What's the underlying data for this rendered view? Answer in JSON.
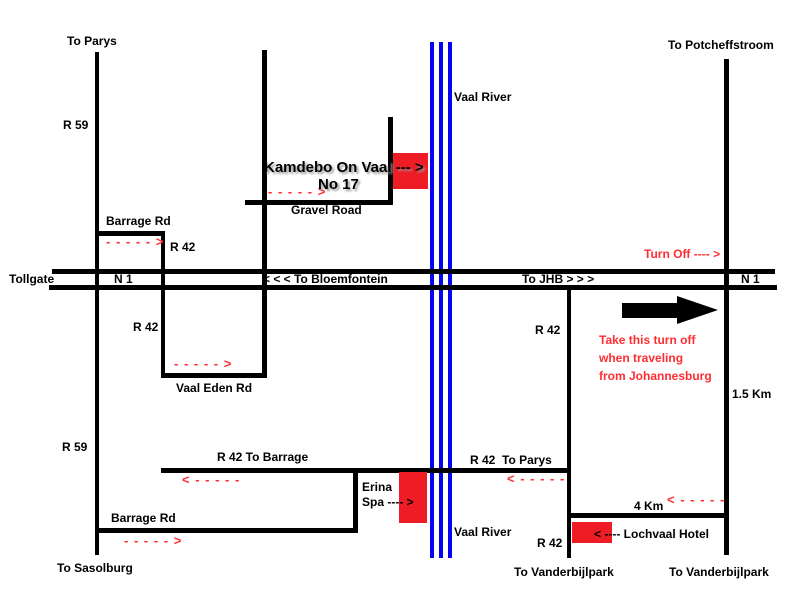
{
  "destinations": {
    "parys": "To Parys",
    "potcheffstroom": "To Potcheffstroom",
    "sasolburg": "To Sasolburg",
    "vanderbijlpark_left": "To Vanderbijlpark",
    "vanderbijlpark_right": "To Vanderbijlpark"
  },
  "highway": {
    "tollgate": "Tollgate",
    "n1_left": "N 1",
    "n1_right": "N 1",
    "to_bloemfontein": "< < < To Bloemfontein",
    "to_jhb": "To JHB > > >"
  },
  "roads": {
    "r59_top": "R 59",
    "r59_bottom": "R 59",
    "r42_top": "R 42",
    "r42_mid_left": "R 42",
    "r42_mid_right": "R 42",
    "r42_bottom": "R 42",
    "barrage_rd_top": "Barrage Rd",
    "barrage_rd_bottom": "Barrage Rd",
    "gravel_road": "Gravel Road",
    "vaal_eden_rd": "Vaal Eden Rd",
    "r42_to_barrage": "R 42 To Barrage",
    "r42_to_parys": "R 42  To Parys"
  },
  "river": {
    "label_top": "Vaal River",
    "label_bottom": "Vaal River"
  },
  "landmarks": {
    "kamdebo_line1": "Kamdebo On Vaal --- >",
    "kamdebo_line2": "No 17",
    "erina_line1": "Erina",
    "erina_line2": "Spa ---- >",
    "lochvaal": "< ---- Lochvaal Hotel"
  },
  "annotations": {
    "turn_off": "Turn Off ---- >",
    "take_turnoff_line1": "Take this turn off",
    "take_turnoff_line2": "when traveling",
    "take_turnoff_line3": "from Johannesburg",
    "km_1_5": "1.5 Km",
    "km_4": "4 Km"
  },
  "arrows": {
    "right": "- - - - - >",
    "left": "< - - - - -"
  },
  "colors": {
    "road": "#000000",
    "river": "#0404ee",
    "marker": "#ee1c25",
    "accent_red": "#ff2d32"
  }
}
